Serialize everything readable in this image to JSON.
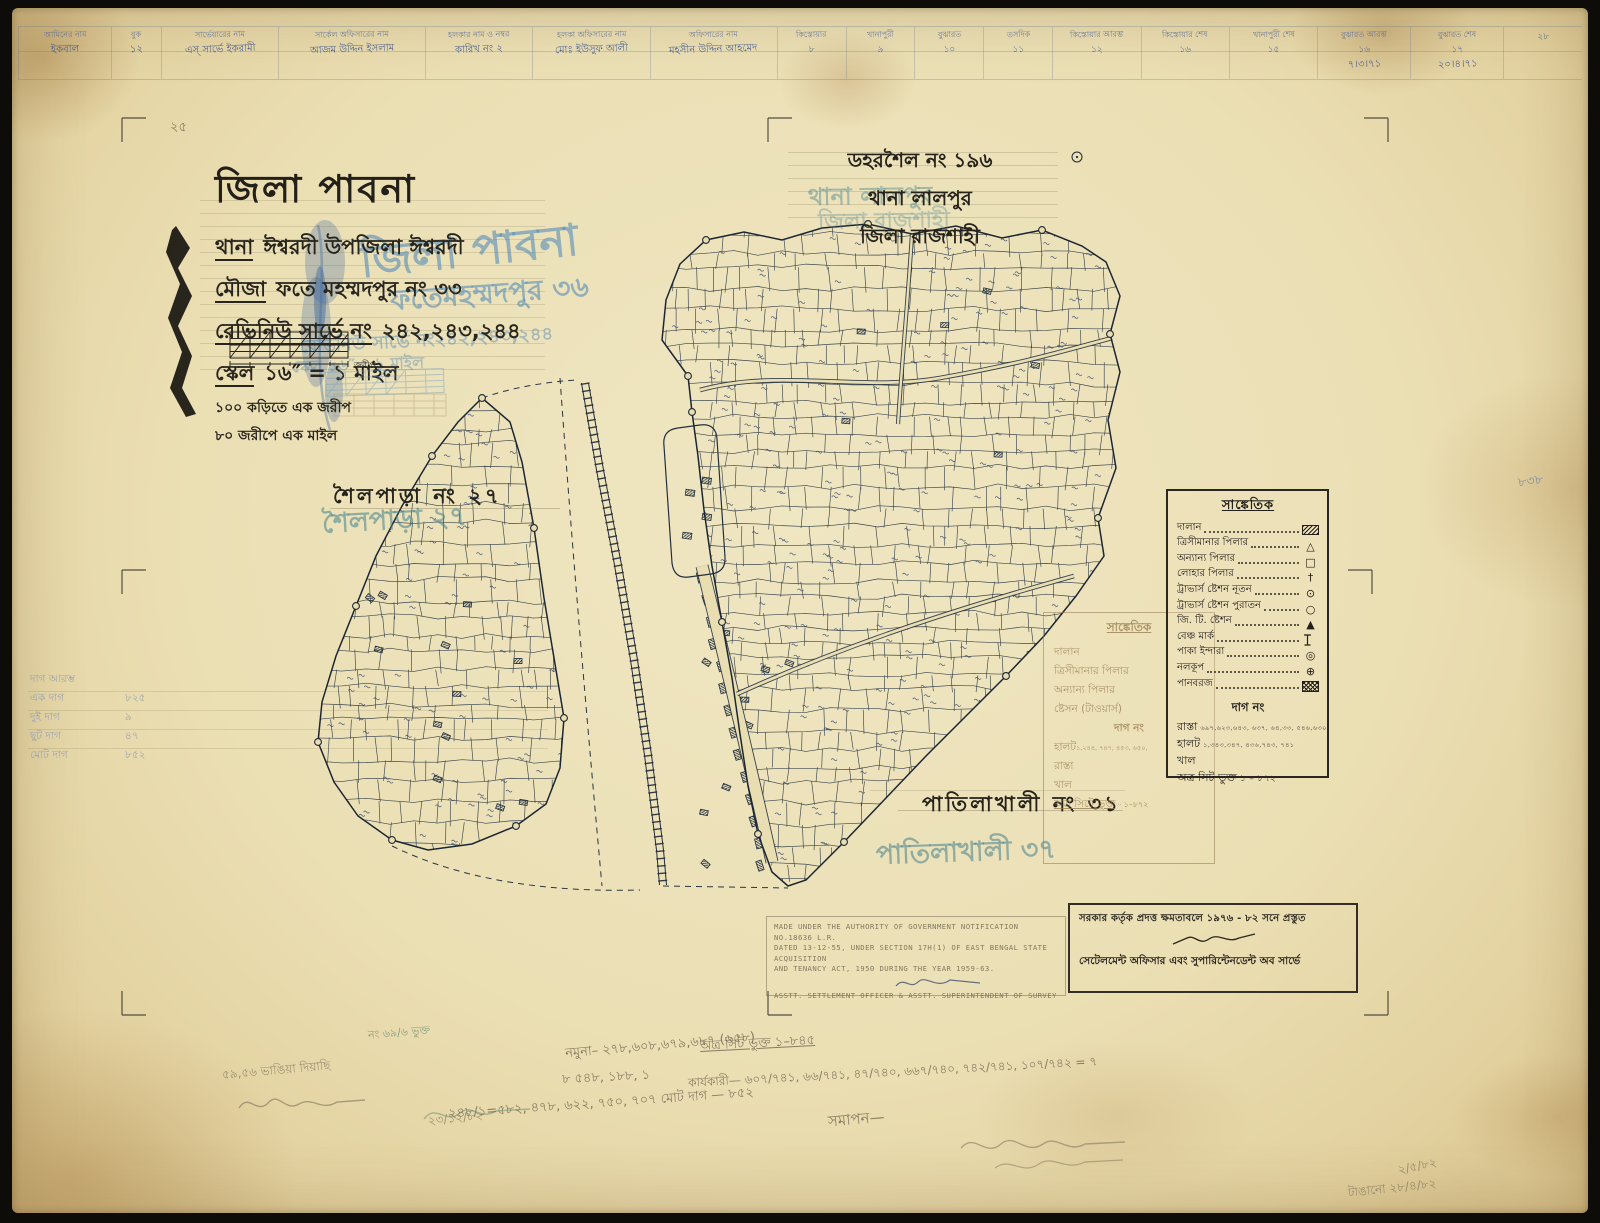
{
  "colors": {
    "paper": "#e9ddb2",
    "ink": "#26231c",
    "map_line": "#22303f",
    "blue_ink": "#41568c",
    "blue_stamp": "#558cb9",
    "teal_stamp": "#46828c",
    "pencil": "#766a56",
    "sepia_ghost": "#a5875a"
  },
  "header_table": {
    "cells": [
      {
        "h": "আমিনের নাম",
        "n": "",
        "v": "ইকবাল"
      },
      {
        "h": "বুক",
        "n": "",
        "v": "১২"
      },
      {
        "h": "সার্ভেয়ারের নাম",
        "n": "",
        "v": "এস্‌ সার্ভে ইকরামী"
      },
      {
        "h": "সার্কেল অফিসারের নাম",
        "n": "",
        "v": "আজম উদ্দিন ইসলাম"
      },
      {
        "h": "হলকার নাম ও নম্বর",
        "n": "",
        "v": "কারিখ নং ২"
      },
      {
        "h": "হলকা অফিসারের নাম",
        "n": "",
        "v": "মোঃ ইউসুফ আলী"
      },
      {
        "h": "অফিসারের নাম",
        "n": "",
        "v": "মহসীন উদ্দিন আহমেদ"
      },
      {
        "h": "কিস্তোয়ার",
        "n": "৮",
        "v": ""
      },
      {
        "h": "খানাপুরী",
        "n": "৯",
        "v": ""
      },
      {
        "h": "বুঝারত",
        "n": "১০",
        "v": ""
      },
      {
        "h": "তসদিক",
        "n": "১১",
        "v": ""
      },
      {
        "h": "কিস্তোয়ার আরম্ভ",
        "n": "১২",
        "v": ""
      },
      {
        "h": "কিস্তোয়ার শেষ",
        "n": "১৬",
        "v": ""
      },
      {
        "h": "খানাপুরী শেষ",
        "n": "১৫",
        "v": ""
      },
      {
        "h": "বুঝারত আরম্ভ",
        "n": "১৬",
        "v": "৭।৩।৭১"
      },
      {
        "h": "বুঝারত শেষ",
        "n": "১৭",
        "v": "২০।৪।৭১"
      },
      {
        "h": "",
        "n": "২৮",
        "v": ""
      }
    ]
  },
  "title_block": {
    "district": "জিলা পাবনা",
    "thana_label": "থানা",
    "thana_value": "ঈশ্বরদী  উপজিলা ঈশ্বরদী",
    "mouza_label": "মৌজা",
    "mouza_value": "ফতে মহম্মদপুর নং ৩৩",
    "revenue_label": "রেভিনিউ সার্ভে নং",
    "revenue_value": "২৪২,২৪৩,২৪৪",
    "scale_label": "স্কেল",
    "scale_value": "১৬″ = ১ মাইল",
    "sub1": "১০০ কড়িতে এক জরীপ",
    "sub2": "৮০ জরীপে এক মাইল",
    "scalebar_unit": "জরীপ"
  },
  "ghost": {
    "district": "জিলা পাবনা",
    "mouza": "ফতেমহম্মদপুর ৩৬",
    "revenue": "রেভিনিউ সার্ভে নং২৪২,২৪৩,২৪৪",
    "scale": "স্কেল ১৬″= ১ মাইল",
    "shailpara": "শৈলপাড়া ২৭",
    "patilakhali": "পাতিলাখালী ৩৭"
  },
  "top_right": {
    "line1": "ডহরশৈল নং ১৯৬",
    "line2": "থানা লালপুর",
    "line3": "জিলা রাজশাহী"
  },
  "neighbors": {
    "shailpara": "শৈলপাড়া নং ২৭",
    "patilakhali": "পাতিলাখালী নং ৩১"
  },
  "legend": {
    "title": "সাঙ্কেতিক",
    "rows": [
      {
        "label": "দালান",
        "symbol": "building-hatch-icon"
      },
      {
        "label": "ত্রিসীমানার পিলার",
        "symbol": "triangle-icon"
      },
      {
        "label": "অন্যান্য পিলার",
        "symbol": "square-icon"
      },
      {
        "label": "লোহার পিলার",
        "symbol": "dagger-icon"
      },
      {
        "label": "ট্রাভার্স ষ্টেশন নূতন",
        "symbol": "circle-dot-icon"
      },
      {
        "label": "ট্রাভার্স ষ্টেশন পুরাতন",
        "symbol": "circle-icon"
      },
      {
        "label": "জি. টি. ষ্টেশন",
        "symbol": "filled-triangle-icon"
      },
      {
        "label": "বেঞ্চ মার্ক",
        "symbol": "benchmark-icon"
      },
      {
        "label": "পাকা ইন্দারা",
        "symbol": "double-circle-icon"
      },
      {
        "label": "নলকূপ",
        "symbol": "circle-plus-icon"
      },
      {
        "label": "পানবরজ",
        "symbol": "crosshatch-icon"
      }
    ],
    "dag_heading": "দাগ নং",
    "dag_rows": [
      {
        "label": "রাস্তা",
        "nums": "৬৯৭,৬২৩,৬৪৩, ৬৩৭, ৬৪,৩৩, ৫৪৬,৬৩০"
      },
      {
        "label": "হালট",
        "nums": "১,৩৪৩,৩৪৭, ৪৩৬,৭৪৩, ৭৪১"
      },
      {
        "label": "খাল",
        "nums": ""
      },
      {
        "label": "অত্র সিট ভুক্ত",
        "nums": "১ – ৮৭২"
      }
    ]
  },
  "ghost_legend": {
    "title": "সাঙ্কেতিক",
    "rows": [
      "দালান",
      "ত্রিসীমানার পিলার",
      "অন্যান্য পিলার",
      "ষ্টেসন (টাওয়ার্স)"
    ],
    "dag_heading": "দাগ নং",
    "rows2": [
      {
        "label": "হালট",
        "nums": "১,২৪৪, ৭৪৭, ৪৫৩, ৬৫০,"
      },
      {
        "label": "রাস্তা",
        "nums": ""
      },
      {
        "label": "খাল",
        "nums": ""
      },
      {
        "label": "অত্র সিটে ভুক্ত",
        "nums": "১–৮৭২"
      }
    ]
  },
  "bn_stamp": {
    "line1": "সরকার কর্তৃক প্রদত্ত ক্ষমতাবলে ১৯৭৬ - ৮২ সনে প্রস্তুত",
    "line2": "সেটেলমেন্ট অফিসার এবং সুপারিন্টেনডেন্ট অব সার্ভে"
  },
  "en_stamp": {
    "line1": "MADE UNDER THE AUTHORITY OF GOVERNMENT NOTIFICATION NO.18636 L.R.",
    "line2": "DATED 13-12-55, UNDER SECTION 17H(1) OF EAST BENGAL STATE ACQUISITION",
    "line3": "AND TENANCY ACT, 1950 DURING THE YEAR 1959-63.",
    "line4": "ASSTT. SETTLEMENT OFFICER & ASSTT. SUPERINTENDENT OF SURVEY"
  },
  "mini_table": {
    "rows": [
      {
        "label": "দাগ আরম্ভ",
        "value": ""
      },
      {
        "label": "এক দাগ",
        "value": "৮২৫"
      },
      {
        "label": "দুই দাগ",
        "value": "৯"
      },
      {
        "label": "ছুট দাগ",
        "value": "৪৭"
      },
      {
        "label": "মোট দাগ",
        "value": "৮৫২"
      }
    ]
  },
  "pencil": {
    "notes": [
      "২৫",
      "৫৯,৫৬ ভাঙিয়া দিয়াছি",
      "২৩/১২/৮২",
      "নমুনা– ২৭৮,৬০৮,৬৭৯,৬৮৭ (৬৫৮)",
      "৮   ৫৪৮, ১৮৮, ১",
      "অত্র সিট ভুক্ত  ১–৮৪৫",
      "কার্যকারী— ৬০৭/৭৪১, ৬৬/৭৪১, ৪৭/৭৪০, ৬৬৭/৭৪০, ৭৪২/৭৪১, ১০৭/৭৪২ = ৭",
      "২৪৮/১=৫৮২, ৪৭৮, ৬২২, ৭৫০, ৭০৭    মোট দাগ — ৮৫২",
      "সমাপন—",
      "২/৫/৮২",
      "টাঙানো ২৮/৪/৮২",
      "৮৩৮",
      "নং ৬৯/৬ ভুক্ত"
    ]
  }
}
